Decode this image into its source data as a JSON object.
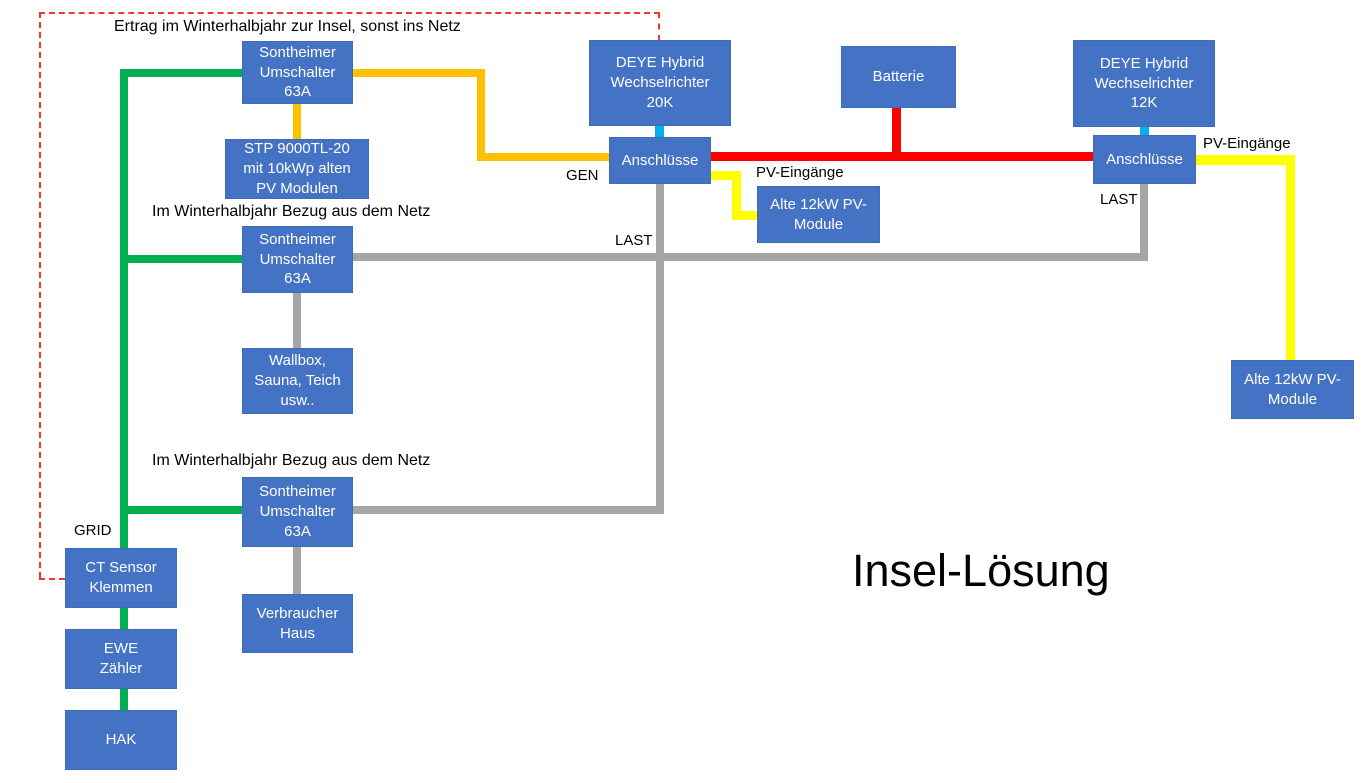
{
  "slide_title": "Insel-Lösung",
  "colors": {
    "box_fill": "#4472C4",
    "box_border": "#3E6CB5",
    "node_text": "#FFFFFF",
    "label_text": "#000000",
    "green": "#00B050",
    "gold": "#FFC000",
    "red": "#FF0000",
    "yellow": "#FFFF00",
    "cyan": "#00B0F0",
    "gray": "#A6A6A6",
    "dash_red": "#F5372B"
  },
  "nodes": [
    {
      "id": "sontheimer-umschalter-1",
      "label": "Sontheimer\nUmschalter\n63A",
      "x": 242,
      "y": 41,
      "w": 111,
      "h": 63
    },
    {
      "id": "stp-9000tl-20",
      "label": "STP 9000TL-20\nmit 10kWp alten\nPV Modulen",
      "x": 225,
      "y": 139,
      "w": 144,
      "h": 60
    },
    {
      "id": "sontheimer-umschalter-2",
      "label": "Sontheimer\nUmschalter\n63A",
      "x": 242,
      "y": 226,
      "w": 111,
      "h": 67
    },
    {
      "id": "wallbox-sauna-teich",
      "label": "Wallbox,\nSauna, Teich\nusw..",
      "x": 242,
      "y": 348,
      "w": 111,
      "h": 66
    },
    {
      "id": "sontheimer-umschalter-3",
      "label": "Sontheimer\nUmschalter\n63A",
      "x": 242,
      "y": 477,
      "w": 111,
      "h": 70
    },
    {
      "id": "verbraucher-haus",
      "label": "Verbraucher\nHaus",
      "x": 242,
      "y": 594,
      "w": 111,
      "h": 59
    },
    {
      "id": "ct-sensor-klemmen",
      "label": "CT Sensor\nKlemmen",
      "x": 65,
      "y": 548,
      "w": 112,
      "h": 60
    },
    {
      "id": "ewe-zaehler",
      "label": "EWE\nZähler",
      "x": 65,
      "y": 629,
      "w": 112,
      "h": 60
    },
    {
      "id": "hak",
      "label": "HAK",
      "x": 65,
      "y": 710,
      "w": 112,
      "h": 60
    },
    {
      "id": "deye-hybrid-20k",
      "label": "DEYE Hybrid\nWechselrichter\n20K",
      "x": 589,
      "y": 40,
      "w": 142,
      "h": 86
    },
    {
      "id": "anschluesse-links",
      "label": "Anschlüsse",
      "x": 609,
      "y": 137,
      "w": 102,
      "h": 47
    },
    {
      "id": "alte-pv-module-links",
      "label": "Alte 12kW PV-\nModule",
      "x": 757,
      "y": 186,
      "w": 123,
      "h": 57
    },
    {
      "id": "batterie",
      "label": "Batterie",
      "x": 841,
      "y": 46,
      "w": 115,
      "h": 62
    },
    {
      "id": "deye-hybrid-12k",
      "label": "DEYE Hybrid\nWechselrichter\n12K",
      "x": 1073,
      "y": 40,
      "w": 142,
      "h": 87
    },
    {
      "id": "anschluesse-rechts",
      "label": "Anschlüsse",
      "x": 1093,
      "y": 135,
      "w": 103,
      "h": 49
    },
    {
      "id": "alte-pv-module-rechts",
      "label": "Alte 12kW PV-\nModule",
      "x": 1231,
      "y": 360,
      "w": 123,
      "h": 59
    }
  ],
  "labels": [
    {
      "id": "ertrag-note",
      "text": "Ertrag im Winterhalbjahr zur Insel, sonst ins Netz",
      "x": 114,
      "y": 18,
      "size": 16
    },
    {
      "id": "winter-note-1",
      "text": "Im Winterhalbjahr Bezug aus dem Netz",
      "x": 152,
      "y": 203,
      "size": 16
    },
    {
      "id": "winter-note-2",
      "text": "Im Winterhalbjahr Bezug aus dem Netz",
      "x": 152,
      "y": 452,
      "size": 16
    },
    {
      "id": "gen-label",
      "text": "GEN",
      "x": 566,
      "y": 168,
      "size": 15
    },
    {
      "id": "last-label-links",
      "text": "LAST",
      "x": 615,
      "y": 233,
      "size": 15
    },
    {
      "id": "pv-eingaenge-links",
      "text": "PV-Eingänge",
      "x": 756,
      "y": 165,
      "size": 15
    },
    {
      "id": "pv-eingaenge-rechts",
      "text": "PV-Eingänge",
      "x": 1203,
      "y": 136,
      "size": 15
    },
    {
      "id": "last-label-rechts",
      "text": "LAST",
      "x": 1100,
      "y": 192,
      "size": 15
    },
    {
      "id": "grid-label",
      "text": "GRID",
      "x": 74,
      "y": 523,
      "size": 15
    },
    {
      "id": "diagram-title",
      "text": "Insel-Lösung",
      "x": 852,
      "y": 546,
      "size": 45
    }
  ],
  "segments": [
    {
      "id": "grid-trunk-line",
      "color": "green",
      "x": 120,
      "y": 69,
      "w": 8,
      "h": 641
    },
    {
      "id": "grid-branch-oben",
      "color": "green",
      "x": 120,
      "y": 69,
      "w": 122,
      "h": 8
    },
    {
      "id": "grid-branch-mitte",
      "color": "green",
      "x": 120,
      "y": 255,
      "w": 122,
      "h": 8
    },
    {
      "id": "grid-branch-unten",
      "color": "green",
      "x": 120,
      "y": 506,
      "w": 122,
      "h": 8
    },
    {
      "id": "gen-line-oben",
      "color": "gold",
      "x": 353,
      "y": 69,
      "w": 132,
      "h": 8
    },
    {
      "id": "gen-line-vertikal",
      "color": "gold",
      "x": 477,
      "y": 69,
      "w": 8,
      "h": 92
    },
    {
      "id": "gen-line-unten",
      "color": "gold",
      "x": 477,
      "y": 153,
      "w": 132,
      "h": 8
    },
    {
      "id": "stp-verbindung",
      "color": "gold",
      "x": 293,
      "y": 104,
      "w": 8,
      "h": 35
    },
    {
      "id": "batterie-bus",
      "color": "red",
      "x": 711,
      "y": 152,
      "w": 382,
      "h": 9
    },
    {
      "id": "batterie-abzweig",
      "color": "red",
      "x": 892,
      "y": 108,
      "w": 9,
      "h": 53
    },
    {
      "id": "link-deye20k-anschluesse",
      "color": "cyan",
      "x": 655,
      "y": 126,
      "w": 9,
      "h": 11
    },
    {
      "id": "link-deye12k-anschluesse",
      "color": "cyan",
      "x": 1140,
      "y": 127,
      "w": 9,
      "h": 8
    },
    {
      "id": "last-abgang-links",
      "color": "gray",
      "x": 656,
      "y": 184,
      "w": 8,
      "h": 330
    },
    {
      "id": "last-bus",
      "color": "gray",
      "x": 353,
      "y": 253,
      "w": 795,
      "h": 8
    },
    {
      "id": "last-zweig-unten",
      "color": "gray",
      "x": 353,
      "y": 506,
      "w": 311,
      "h": 8
    },
    {
      "id": "last-abgang-rechts",
      "color": "gray",
      "x": 1140,
      "y": 184,
      "w": 8,
      "h": 77
    },
    {
      "id": "wallbox-verbindung",
      "color": "gray",
      "x": 293,
      "y": 293,
      "w": 8,
      "h": 56
    },
    {
      "id": "verbraucher-verbindung",
      "color": "gray",
      "x": 293,
      "y": 547,
      "w": 8,
      "h": 47
    },
    {
      "id": "pv-leitung-links-1",
      "color": "yellow",
      "x": 711,
      "y": 171,
      "w": 30,
      "h": 9
    },
    {
      "id": "pv-leitung-links-2",
      "color": "yellow",
      "x": 732,
      "y": 171,
      "w": 9,
      "h": 49
    },
    {
      "id": "pv-leitung-links-3",
      "color": "yellow",
      "x": 732,
      "y": 211,
      "w": 25,
      "h": 9
    },
    {
      "id": "pv-leitung-rechts-1",
      "color": "yellow",
      "x": 1196,
      "y": 155,
      "w": 99,
      "h": 10
    },
    {
      "id": "pv-leitung-rechts-2",
      "color": "yellow",
      "x": 1286,
      "y": 155,
      "w": 9,
      "h": 205
    }
  ],
  "dashes": [
    {
      "id": "dash-oben",
      "orient": "h",
      "x": 39,
      "y": 12,
      "len": 621
    },
    {
      "id": "dash-zu-deye",
      "orient": "v",
      "x": 658,
      "y": 12,
      "len": 29
    },
    {
      "id": "dash-links",
      "orient": "v",
      "x": 39,
      "y": 12,
      "len": 566
    },
    {
      "id": "dash-zu-ct-sensor",
      "orient": "h",
      "x": 39,
      "y": 578,
      "len": 26
    }
  ]
}
